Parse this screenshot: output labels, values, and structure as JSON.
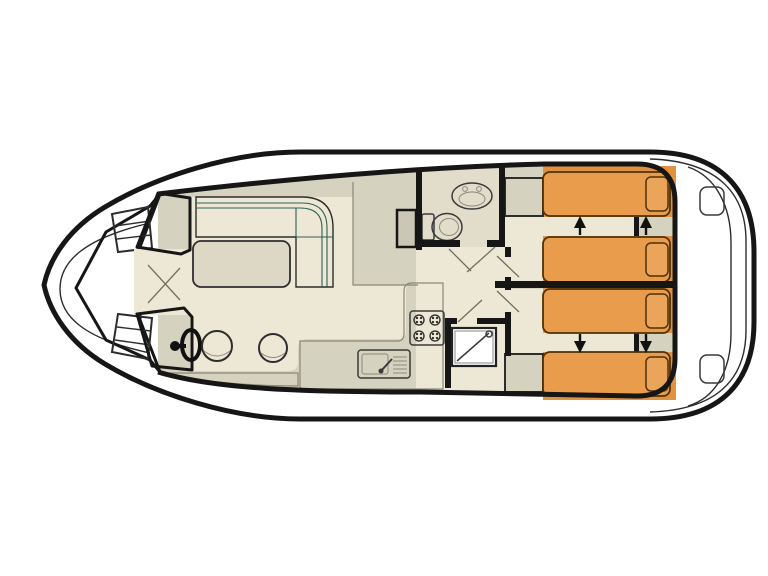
{
  "meta": {
    "diagram_type": "boat-deck-floor-plan",
    "orientation": "bow-left-stern-right",
    "text_labels": []
  },
  "colors": {
    "page": "#ffffff",
    "hull_fill": "#ffffff",
    "wall": "#161616",
    "deck_cream": "#e9e5d1",
    "floor_cream": "#ece8d5",
    "deck_gray": "#d5d2bf",
    "shield_gray": "#cac7b5",
    "bath_floor": "#e1ddca",
    "sofa_teal": "#8fccbe",
    "table_fill": "#dcd8c5",
    "orange_panel": "#e2913f",
    "bed_fill": "#e89c4c",
    "pillow_fill": "#eba55a",
    "bed_line": "#4f3208",
    "stairs_light": "#f2f0e6",
    "stairs_dark": "#c9c6b5",
    "fixture_white": "#ffffff",
    "arrow": "#111111"
  },
  "plan": {
    "areas": [
      {
        "id": "bow-deck",
        "features": [
          "bench-seat",
          "bench-seat",
          "door-swing-lines"
        ]
      },
      {
        "id": "saloon",
        "features": [
          "l-shaped-sofa",
          "table",
          "windshield-panel-port",
          "windshield-panel-starboard",
          "helm-wheel",
          "stool",
          "stool",
          "side-cabinet"
        ]
      },
      {
        "id": "galley",
        "features": [
          "stove-4-burners",
          "sink-with-drainer",
          "counter"
        ]
      },
      {
        "id": "bathroom",
        "features": [
          "washbasin",
          "toilet",
          "cabinet"
        ]
      },
      {
        "id": "shower-room",
        "features": [
          "shower-tray"
        ]
      },
      {
        "id": "corridor",
        "features": [
          "door-swing",
          "door-swing",
          "door-swing",
          "door-swing",
          "door-swing"
        ]
      },
      {
        "id": "stairs-forward",
        "steps": true
      },
      {
        "id": "stairs-aft",
        "steps": true
      },
      {
        "id": "cabin-port-aft",
        "beds": 2,
        "pillows": 2,
        "slide_arrows": "up"
      },
      {
        "id": "cabin-starboard-aft",
        "beds": 2,
        "pillows": 2,
        "slide_arrows": "down"
      },
      {
        "id": "stern-deck",
        "features": [
          "transom-bench",
          "step-pad",
          "step-pad"
        ]
      }
    ]
  }
}
